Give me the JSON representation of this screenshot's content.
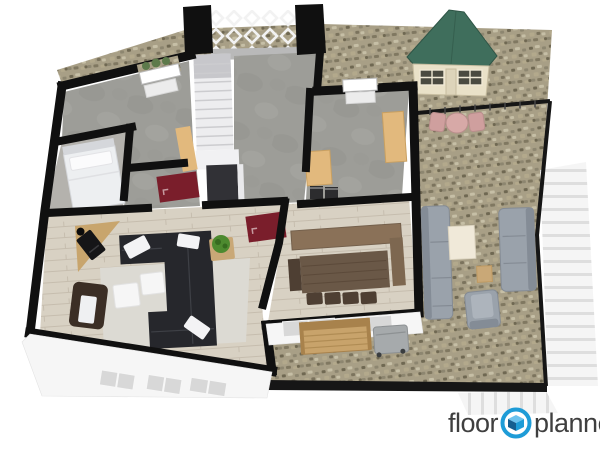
{
  "logo": {
    "word_left": "floor",
    "word_right": "planner",
    "icon": "floorplanner-cube-icon"
  },
  "scene": {
    "rooms": [
      {
        "name": "entry-hall",
        "floor": "concrete",
        "features": [
          "staircase",
          "lattice-trellis-wall",
          "red-doormat"
        ]
      },
      {
        "name": "storage-room",
        "floor": "concrete",
        "features": [
          "window",
          "tan-cabinet"
        ]
      },
      {
        "name": "bedroom",
        "floor": "concrete",
        "features": [
          "single-bed-white"
        ]
      },
      {
        "name": "office",
        "floor": "concrete",
        "features": [
          "window",
          "two-tan-desks",
          "two-dark-appliances"
        ]
      },
      {
        "name": "living-room",
        "floor": "wood-planks",
        "features": [
          "black-corner-sofa",
          "white-throw-pillows",
          "two-white-coffee-tables",
          "light-area-rug",
          "wood-stove-on-corner-hearth",
          "brown-armchair-white-cushion",
          "dark-lounge-chair",
          "plant-on-side-table",
          "dark-red-rug"
        ]
      },
      {
        "name": "dining-room",
        "floor": "wood-planks",
        "features": [
          "dark-wood-table",
          "four-chairs",
          "long-sideboard",
          "side-bench"
        ]
      }
    ],
    "outdoor": {
      "ground": "gravel-patio",
      "garden_shed": {
        "roof": "green-gable",
        "walls": "cream",
        "windows": 2,
        "door": 1
      },
      "furniture": [
        "pink-bistro-table-with-two-chairs",
        "gray-outdoor-sofa-long",
        "gray-outdoor-sofa-short",
        "cream-coffee-table",
        "tan-side-table",
        "gray-armchair",
        "wooden-garden-bench",
        "gray-storage-box"
      ],
      "fences": [
        "dark-perimeter-fence",
        "white-slat-fence-right",
        "white-slat-fence-bottom",
        "white-lattice-trellis"
      ]
    }
  },
  "colors": {
    "page_bg": "#ffffff",
    "wall": "#101010",
    "gravel_base": "#a89f86",
    "gravel_dark": "#6f6852",
    "gravel_mid": "#8d8670",
    "gravel_light": "#c6bfa6",
    "gravel_warm": "#b3a98c",
    "concrete": "#9d9d98",
    "concrete_light": "#a9a9a4",
    "concrete_dark": "#8f8f8a",
    "bedroom_floor": "#b4b2ad",
    "wood_floor": "#d8d1c3",
    "wood_line": "#c6bdae",
    "rug": "#dcdad3",
    "sofa_black": "#26272c",
    "sofa_seam": "#3e4046",
    "pillow": "#f3f3f5",
    "armchair_brown": "#3b2e25",
    "cushion_white": "#eff0f2",
    "stove_black": "#151517",
    "hearth_tan": "#c8a56d",
    "table_white": "#f6f6f6",
    "side_table_tan": "#c9a877",
    "plant_green": "#4d8a2f",
    "plant_dark": "#366b1f",
    "red_rug": "#7a1e2b",
    "bed_white": "#edeff1",
    "bed_trim": "#d5d7db",
    "dining_table": "#6a5847",
    "dining_grain": "#5c4a3a",
    "sideboard": "#8a7158",
    "dining_chair": "#4e3f33",
    "desk_tan": "#e2b97d",
    "appliance_dark": "#2c2c2e",
    "shed_roof": "#3f6e5c",
    "shed_roof_edge": "#2f5546",
    "shed_wall": "#e9e1c8",
    "shed_wall_edge": "#c7bda0",
    "bistro_pink": "#d7a9a7",
    "bistro_edge": "#b98e8c",
    "out_sofa": "#9aa2ab",
    "out_sofa_back": "#848c96",
    "out_sofa_cushion": "#adb4bc",
    "out_table_cream": "#f0e9d9",
    "bench_wood": "#c8a36b",
    "bench_wood_dark": "#a8824c",
    "box_gray": "#a6aaac",
    "fence_dark": "#161616",
    "fence_tick": "#454545",
    "slat_light": "#f5f5f5",
    "slat_line": "#dedede",
    "stair_white": "#ededef",
    "stair_tread": "#cccccf",
    "stair_shadow": "#c7c7cb",
    "landing": "#f1f1f3",
    "understair": "#313136",
    "lattice_white": "#f2f2f2",
    "wall_band_gray": "#b9b9b9",
    "ext_wall_white": "#f6f6f6",
    "window_inset": "#d8d8d8",
    "window_frame": "#b9b9b9",
    "sill": "#ececec",
    "logo_text": "#3f3f3f",
    "logo_blue": "#1e9cd7",
    "logo_blue_dark": "#155e8f",
    "logo_blue_light": "#6cc3ee"
  }
}
